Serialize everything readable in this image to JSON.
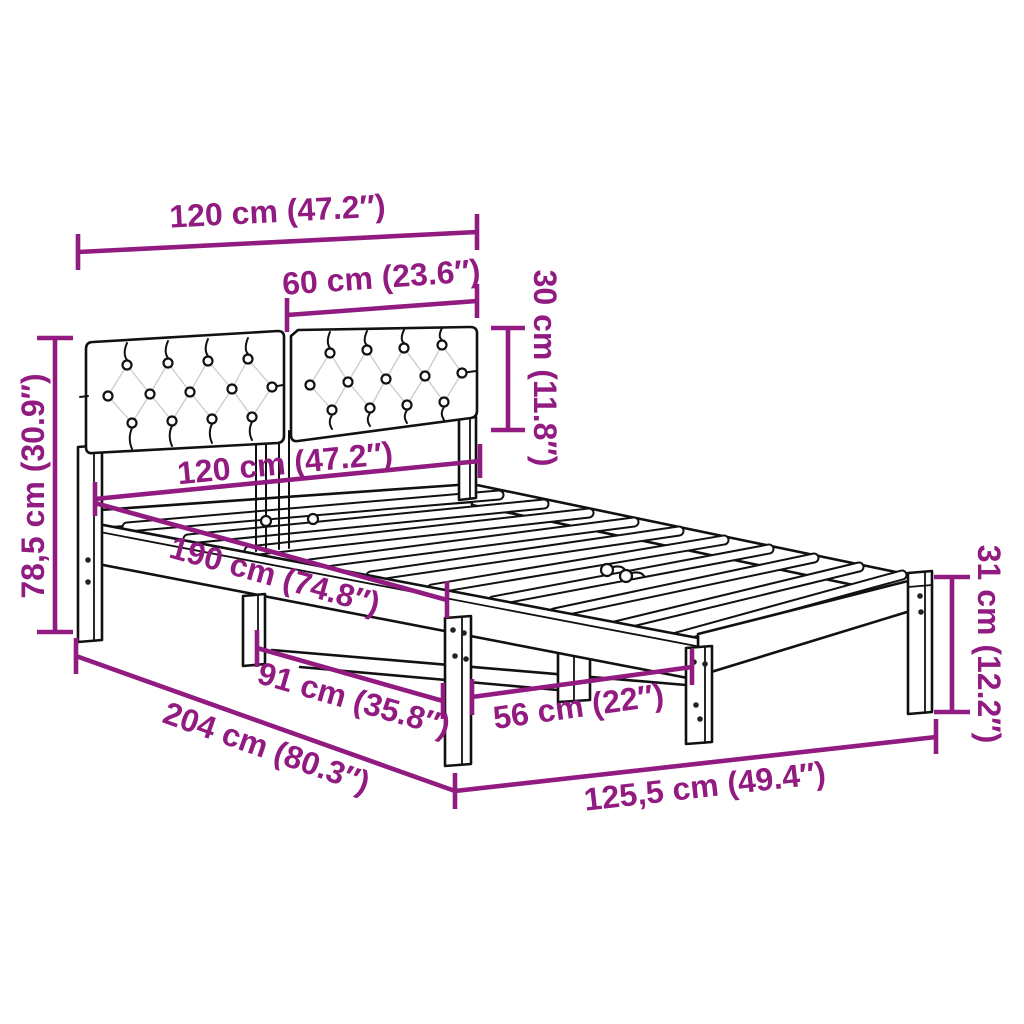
{
  "figure": {
    "subject": "Bed frame with upholstered tufted headboard — product dimension diagram",
    "style": "black line drawing with magenta dimension arrows on white",
    "colors": {
      "dimension_lines": "#911B80",
      "outline": "#111111",
      "background": "#FFFFFF"
    }
  },
  "dims": {
    "top_width": "120 cm (47.2″)",
    "headboard_panel_width": "60 cm (23.6″)",
    "headboard_height": "30 cm (11.8″)",
    "frame_width": "120 cm (47.2″)",
    "frame_length": "190 cm (74.8″)",
    "total_height": "78,5 cm (30.9″)",
    "leg_gap_head": "91 cm (35.8″)",
    "total_length": "204 cm (80.3″)",
    "leg_gap_foot": "56 cm (22″)",
    "base_length_front": "125,5 cm (49.4″)",
    "leg_height": "31 cm (12.2″)"
  }
}
